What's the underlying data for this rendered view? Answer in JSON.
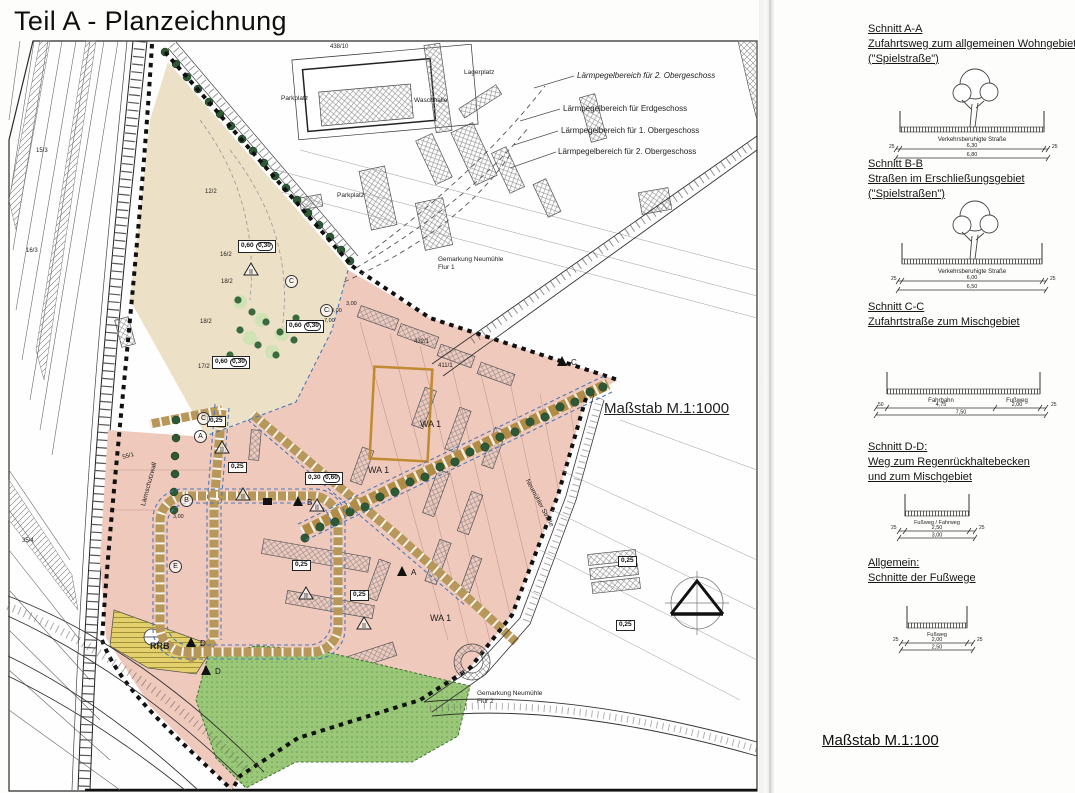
{
  "title": "Teil A - Planzeichnung",
  "map": {
    "scale_label": "Maßstab M.1:1000",
    "colors": {
      "residential_pink": "#f0c9bd",
      "park_beige": "#ece0c6",
      "green_space": "#9ac878",
      "basin_yellow": "#e3cf6b",
      "road_olive": "#b7985a",
      "tree_green": "#2d5a35",
      "boundary_blue": "#4d79b5",
      "orange_outline": "#c08a30"
    },
    "labels": [
      {
        "t": "Lärmpegelbereich für 2. Obergeschoss",
        "x": 577,
        "y": 72,
        "s": 8,
        "i": true
      },
      {
        "t": "Lärmpegelbereich für Erdgeschoss",
        "x": 563,
        "y": 105,
        "s": 8
      },
      {
        "t": "Lärmpegelbereich für 1. Obergeschoss",
        "x": 561,
        "y": 127,
        "s": 8
      },
      {
        "t": "Lärmpegelbereich für 2. Obergeschoss",
        "x": 558,
        "y": 148,
        "s": 8
      },
      {
        "t": "Maßstab M.1:1000",
        "x": 604,
        "y": 401,
        "s": 15,
        "u": true
      },
      {
        "t": "Parkplatz",
        "x": 281,
        "y": 95,
        "s": 6.5
      },
      {
        "t": "Waschhalle",
        "x": 414,
        "y": 97,
        "s": 6.5
      },
      {
        "t": "Lagerplatz",
        "x": 464,
        "y": 69,
        "s": 6.5
      },
      {
        "t": "Parkplatz",
        "x": 337,
        "y": 192,
        "s": 6.5
      },
      {
        "t": "Gemarkung Neumühle",
        "x": 438,
        "y": 256,
        "s": 6.5
      },
      {
        "t": "Flur 1",
        "x": 438,
        "y": 264,
        "s": 6.5
      },
      {
        "t": "Gemarkung Neumühle",
        "x": 477,
        "y": 690,
        "s": 6.5
      },
      {
        "t": "Flur 2",
        "x": 477,
        "y": 698,
        "s": 6.5
      },
      {
        "t": "RRB",
        "x": 150,
        "y": 642,
        "s": 9,
        "b": true
      },
      {
        "t": "WA 1",
        "x": 420,
        "y": 420,
        "s": 9
      },
      {
        "t": "WA 1",
        "x": 368,
        "y": 466,
        "s": 9
      },
      {
        "t": "WA 1",
        "x": 430,
        "y": 614,
        "s": 9
      },
      {
        "t": "Lärmschutzwall",
        "x": 140,
        "y": 505,
        "s": 6.5,
        "r": -75
      },
      {
        "t": "Neumühler Straße",
        "x": 530,
        "y": 478,
        "s": 6.5,
        "r": 62
      },
      {
        "t": "12/2",
        "x": 205,
        "y": 189,
        "s": 6
      },
      {
        "t": "16/2",
        "x": 220,
        "y": 252,
        "s": 6
      },
      {
        "t": "18/2",
        "x": 221,
        "y": 279,
        "s": 6
      },
      {
        "t": "18/2",
        "x": 200,
        "y": 319,
        "s": 6
      },
      {
        "t": "17/2",
        "x": 198,
        "y": 364,
        "s": 6
      },
      {
        "t": "438/10",
        "x": 330,
        "y": 44,
        "s": 6
      },
      {
        "t": "432/1",
        "x": 414,
        "y": 339,
        "s": 6
      },
      {
        "t": "411/1",
        "x": 438,
        "y": 363,
        "s": 6
      },
      {
        "t": "55/1",
        "x": 122,
        "y": 455,
        "s": 6,
        "r": -15
      },
      {
        "t": "15/3",
        "x": 36,
        "y": 148,
        "s": 6
      },
      {
        "t": "16/3",
        "x": 26,
        "y": 248,
        "s": 6
      },
      {
        "t": "35/4",
        "x": 22,
        "y": 538,
        "s": 6
      },
      {
        "t": "10,00",
        "x": 328,
        "y": 308,
        "s": 5.5
      },
      {
        "t": "7,00",
        "x": 324,
        "y": 318,
        "s": 5.5
      },
      {
        "t": "3,00",
        "x": 346,
        "y": 301,
        "s": 5.5
      },
      {
        "t": "3,00",
        "x": 173,
        "y": 514,
        "s": 5.5
      }
    ],
    "measure_boxes": [
      {
        "x": 238,
        "y": 240,
        "a": "0,60",
        "b": "0,30"
      },
      {
        "x": 286,
        "y": 320,
        "a": "0,60",
        "b": "0,30"
      },
      {
        "x": 212,
        "y": 356,
        "a": "0,60",
        "b": "0,30"
      },
      {
        "x": 207,
        "y": 416,
        "a": "0,25"
      },
      {
        "x": 228,
        "y": 462,
        "a": "0,25"
      },
      {
        "x": 292,
        "y": 560,
        "a": "0,25"
      },
      {
        "x": 305,
        "y": 472,
        "a": "0,30",
        "b": "0,60"
      },
      {
        "x": 350,
        "y": 590,
        "a": "0,25"
      },
      {
        "x": 618,
        "y": 556,
        "a": "0,25"
      },
      {
        "x": 616,
        "y": 620,
        "a": "0,25"
      }
    ],
    "floor_triangles": [
      {
        "x": 243,
        "y": 262,
        "t": "II"
      },
      {
        "x": 214,
        "y": 440,
        "t": "II"
      },
      {
        "x": 235,
        "y": 487,
        "t": "II"
      },
      {
        "x": 298,
        "y": 586,
        "t": "II"
      },
      {
        "x": 309,
        "y": 498,
        "t": "II"
      },
      {
        "x": 356,
        "y": 616,
        "t": "II"
      }
    ],
    "section_markers": [
      {
        "x": 292,
        "y": 494,
        "t": "B"
      },
      {
        "x": 396,
        "y": 564,
        "t": "A"
      },
      {
        "x": 185,
        "y": 635,
        "t": "D"
      },
      {
        "x": 200,
        "y": 663,
        "t": "D"
      },
      {
        "x": 556,
        "y": 354,
        "t": "C"
      }
    ],
    "circle_markers": [
      {
        "x": 197,
        "y": 412,
        "t": "C"
      },
      {
        "x": 194,
        "y": 430,
        "t": "A"
      },
      {
        "x": 180,
        "y": 494,
        "t": "B"
      },
      {
        "x": 169,
        "y": 560,
        "t": "E"
      },
      {
        "x": 285,
        "y": 275,
        "t": "C"
      },
      {
        "x": 320,
        "y": 304,
        "t": "C"
      }
    ]
  },
  "right_panel": {
    "sections": [
      {
        "lines": [
          "Schnitt A-A",
          "Zufahrtsweg zum allgemeinen Wohngebiet",
          "(\"Spielstraße\")"
        ],
        "road_label": "Verkehrsberuhigte Straße",
        "side_l": "25",
        "side_r": "25",
        "inner": "6,30",
        "total": "6,80"
      },
      {
        "lines": [
          "Schnitt B-B",
          "Straßen im Erschließungsgebiet",
          "(\"Spielstraßen\")"
        ],
        "road_label": "Verkehrsberuhigte Straße",
        "side_l": "25",
        "side_r": "25",
        "inner": "6,00",
        "total": "6,50"
      },
      {
        "lines": [
          "Schnitt C-C",
          "Zufahrtstraße zum Mischgebiet"
        ],
        "lane_label": "Fahrbahn",
        "walk_label": "Fußweg",
        "side_l": "50",
        "lane": "4,75",
        "walk": "2,00",
        "side_r": "25",
        "total": "7,50"
      },
      {
        "lines": [
          "Schnitt D-D:",
          "Weg zum Regenrückhaltebecken",
          "und zum Mischgebiet"
        ],
        "road_label": "Fußweg / Fahrweg",
        "side_l": "25",
        "side_r": "25",
        "inner": "2,50",
        "total": "3,00"
      },
      {
        "lines": [
          "Allgemein:",
          "Schnitte der Fußwege"
        ],
        "road_label": "Fußweg",
        "side_l": "25",
        "side_r": "25",
        "inner": "2,00",
        "total": "2,50"
      }
    ],
    "scale_label": "Maßstab M.1:100"
  }
}
